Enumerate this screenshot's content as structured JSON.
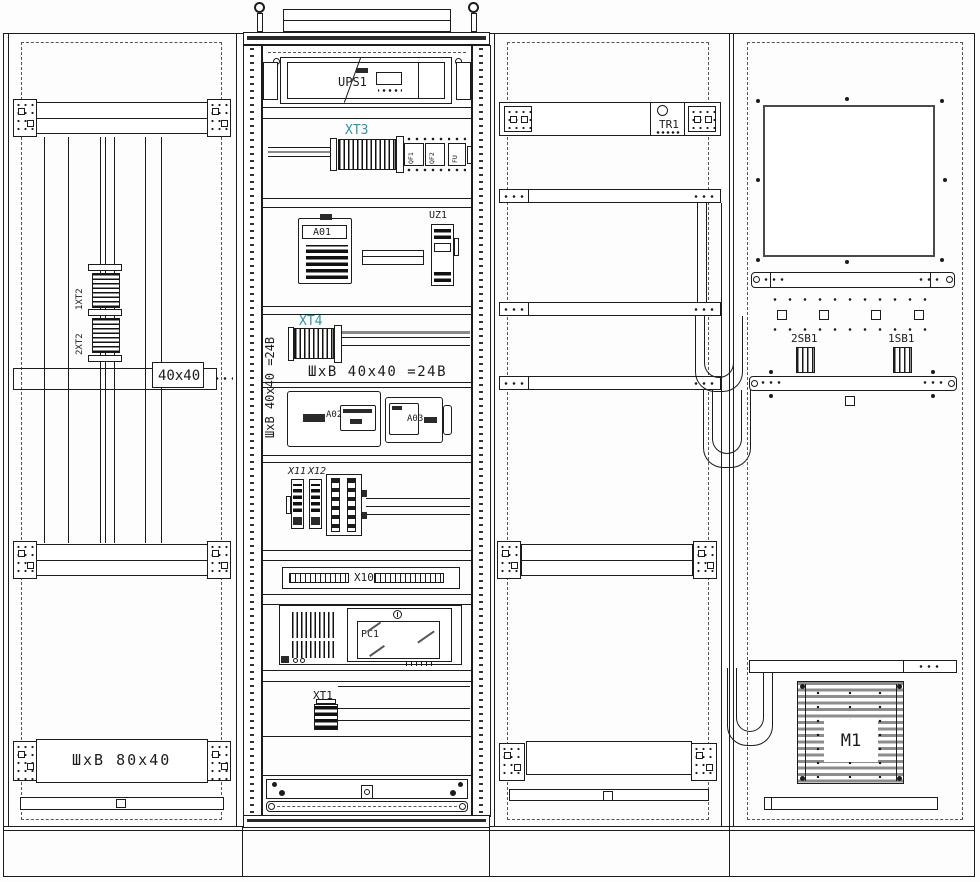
{
  "drawing_title": "Electrical cabinets internal layout drawing",
  "colors": {
    "line": "#1c1c1c",
    "terminal_label_accent": "#2e93a8",
    "background": "#ffffff"
  },
  "panel_left": {
    "terminal_block_top": "1XT2",
    "terminal_block_bottom": "2XT2",
    "duct_size_label": "40x40",
    "bottom_duct_label": "ШхВ 80х40"
  },
  "panel_center": {
    "ups_label": "UPS1",
    "xt3_label": "XT3",
    "breaker_labels": [
      "QF1",
      "QF2",
      "FU"
    ],
    "relay_label": "A01",
    "psu_label": "UZ1",
    "xt4_label": "XT4",
    "duct_label_vertical": "ШхВ 40х40 =24В",
    "duct_label_horizontal": "ШхВ 40х40 =24В",
    "module_a02_label": "A02",
    "module_a03_label": "A03",
    "connector_x11_label": "X11",
    "connector_x12_label": "X12",
    "terminal_strip_label": "X10",
    "computer_label": "PC1",
    "xt1_label": "XT1"
  },
  "panel_mid_right": {
    "transformer_label": "TR1"
  },
  "panel_right": {
    "button2_label": "2SB1",
    "button1_label": "1SB1",
    "fan_label": "M1"
  }
}
